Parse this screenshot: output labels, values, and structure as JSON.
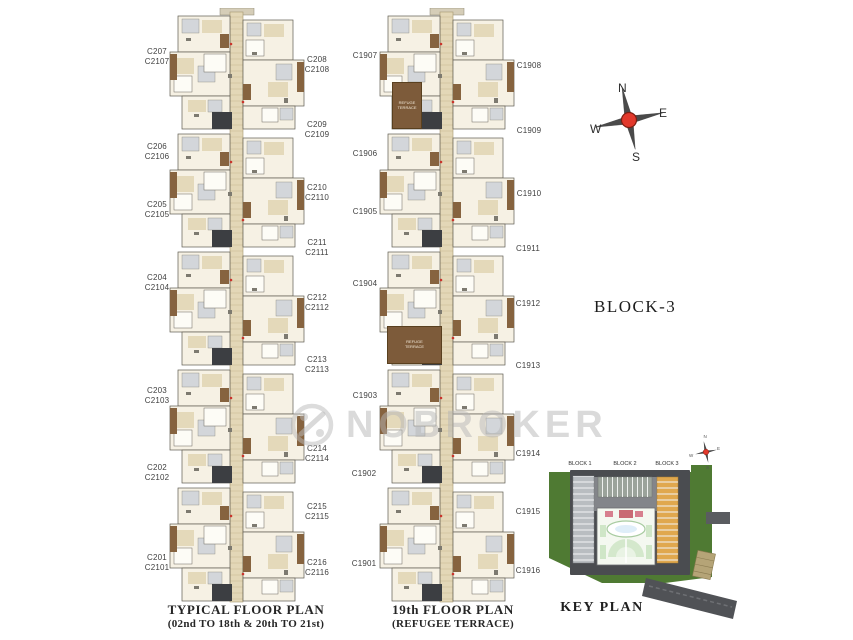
{
  "title": {
    "block": "BLOCK-3"
  },
  "watermark": {
    "brand": "NOBROKER"
  },
  "compass": {
    "n": "N",
    "e": "E",
    "w": "W",
    "s": "S"
  },
  "typical_plan": {
    "caption_line1": "TYPICAL FLOOR PLAN",
    "caption_line2": "(02nd TO 18th & 20th TO 21st)",
    "left_labels": [
      "C207\nC2107",
      "C206\nC2106",
      "C205\nC2105",
      "C204\nC2104",
      "C203\nC2103",
      "C202\nC2102",
      "C201\nC2101"
    ],
    "right_labels": [
      "C208\nC2108",
      "C209\nC2109",
      "C210\nC2110",
      "C211\nC2111",
      "C212\nC2112",
      "C213\nC2113",
      "C214\nC2114",
      "C215\nC2115",
      "C216\nC2116"
    ]
  },
  "refuge_plan": {
    "caption_line1": "19th FLOOR PLAN",
    "caption_line2": "(REFUGEE TERRACE)",
    "left_labels": [
      "C1907",
      "C1906",
      "C1905",
      "C1904",
      "C1903",
      "C1902",
      "C1901"
    ],
    "right_labels": [
      "C1908",
      "C1909",
      "C1910",
      "C1911",
      "C1912",
      "C1913",
      "C1914",
      "C1915",
      "C1916"
    ],
    "terrace_note": "REFUGE\nTERRACE"
  },
  "key_plan": {
    "title": "KEY PLAN",
    "block_labels": [
      "BLOCK 1",
      "BLOCK 2",
      "BLOCK 3"
    ],
    "compass": {
      "n": "N",
      "e": "E",
      "w": "W",
      "s": "S"
    }
  },
  "colors": {
    "compass_red": "#e2392c",
    "site_green": "#4f7a33",
    "block1_gray": "#b9bdc1",
    "block2_gray": "#9ba39b",
    "block3_orange": "#e0a84e",
    "building_dark": "#4a4c50",
    "plan_brown": "#86633f",
    "plan_beige": "#e4d9ba",
    "plan_dark": "#3c3e42"
  }
}
